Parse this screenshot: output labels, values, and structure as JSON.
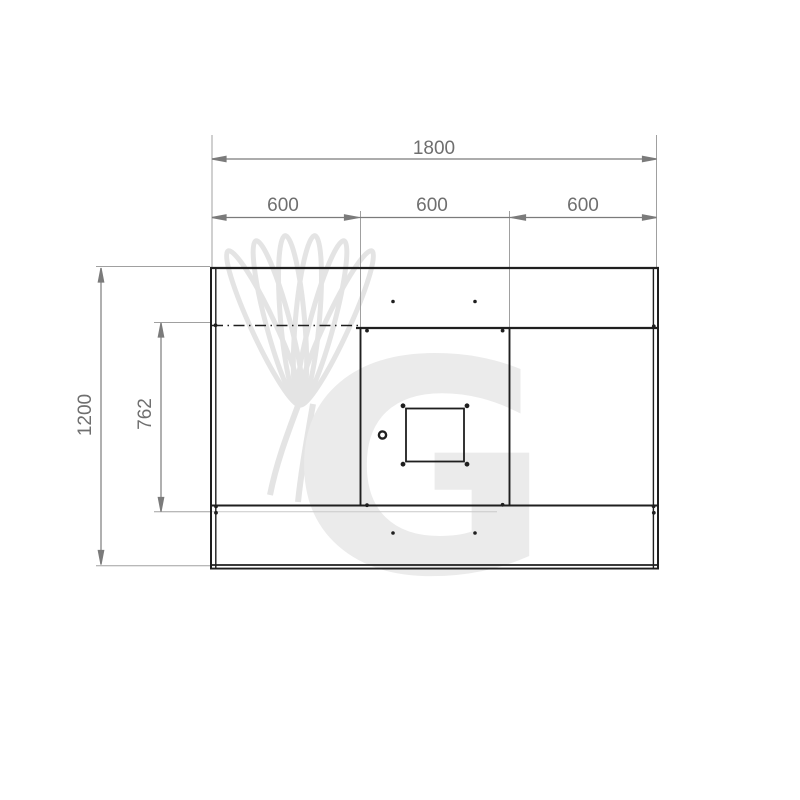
{
  "diagram": {
    "type": "technical-dimension-drawing",
    "view": "bottom-view-panel-with-center-outlet",
    "dimensions": {
      "overall_width_label": "1800",
      "section_labels": [
        "600",
        "600",
        "600"
      ],
      "overall_height_label": "1200",
      "inner_depth_label": "762"
    },
    "watermark": {
      "letter": "G",
      "icon": "chef-hat"
    },
    "colors": {
      "drawing_line": "#1f1f1f",
      "dimension_line": "#7b7b7b",
      "extension_line": "#a0a0a0",
      "dimension_text": "#6f6f6f",
      "watermark": "#e9e9e9",
      "background": "#ffffff"
    }
  }
}
